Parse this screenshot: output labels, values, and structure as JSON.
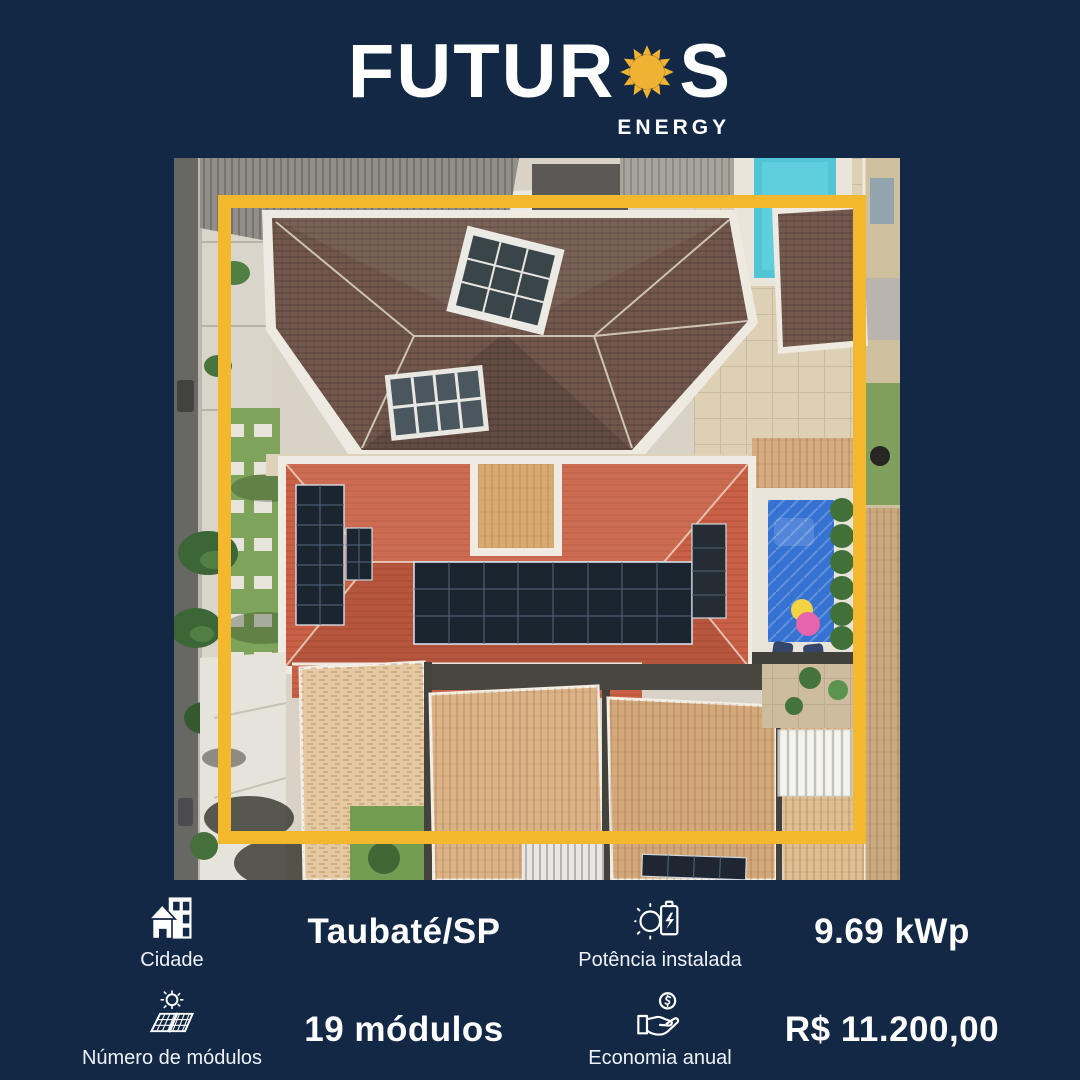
{
  "brand": {
    "name_prefix": "FUTUR",
    "name_suffix": "S",
    "subtitle": "ENERGY"
  },
  "stats": {
    "city": {
      "label": "Cidade",
      "value": "Taubaté/SP",
      "icon": "city-buildings-icon"
    },
    "power": {
      "label": "Potência instalada",
      "value": "9.69 kWp",
      "icon": "sun-battery-icon"
    },
    "modules": {
      "label": "Número de módulos",
      "value": "19 módulos",
      "icon": "sun-solar-panel-icon"
    },
    "savings": {
      "label": "Economia anual",
      "value": "R$ 11.200,00",
      "icon": "hand-coin-icon"
    }
  },
  "icons": {
    "logo": "sun-icon",
    "photo_frame": "yellow-highlight-frame"
  },
  "colors": {
    "background": "#132845",
    "accent": "#F4B82F",
    "text": "#FFFFFF"
  }
}
